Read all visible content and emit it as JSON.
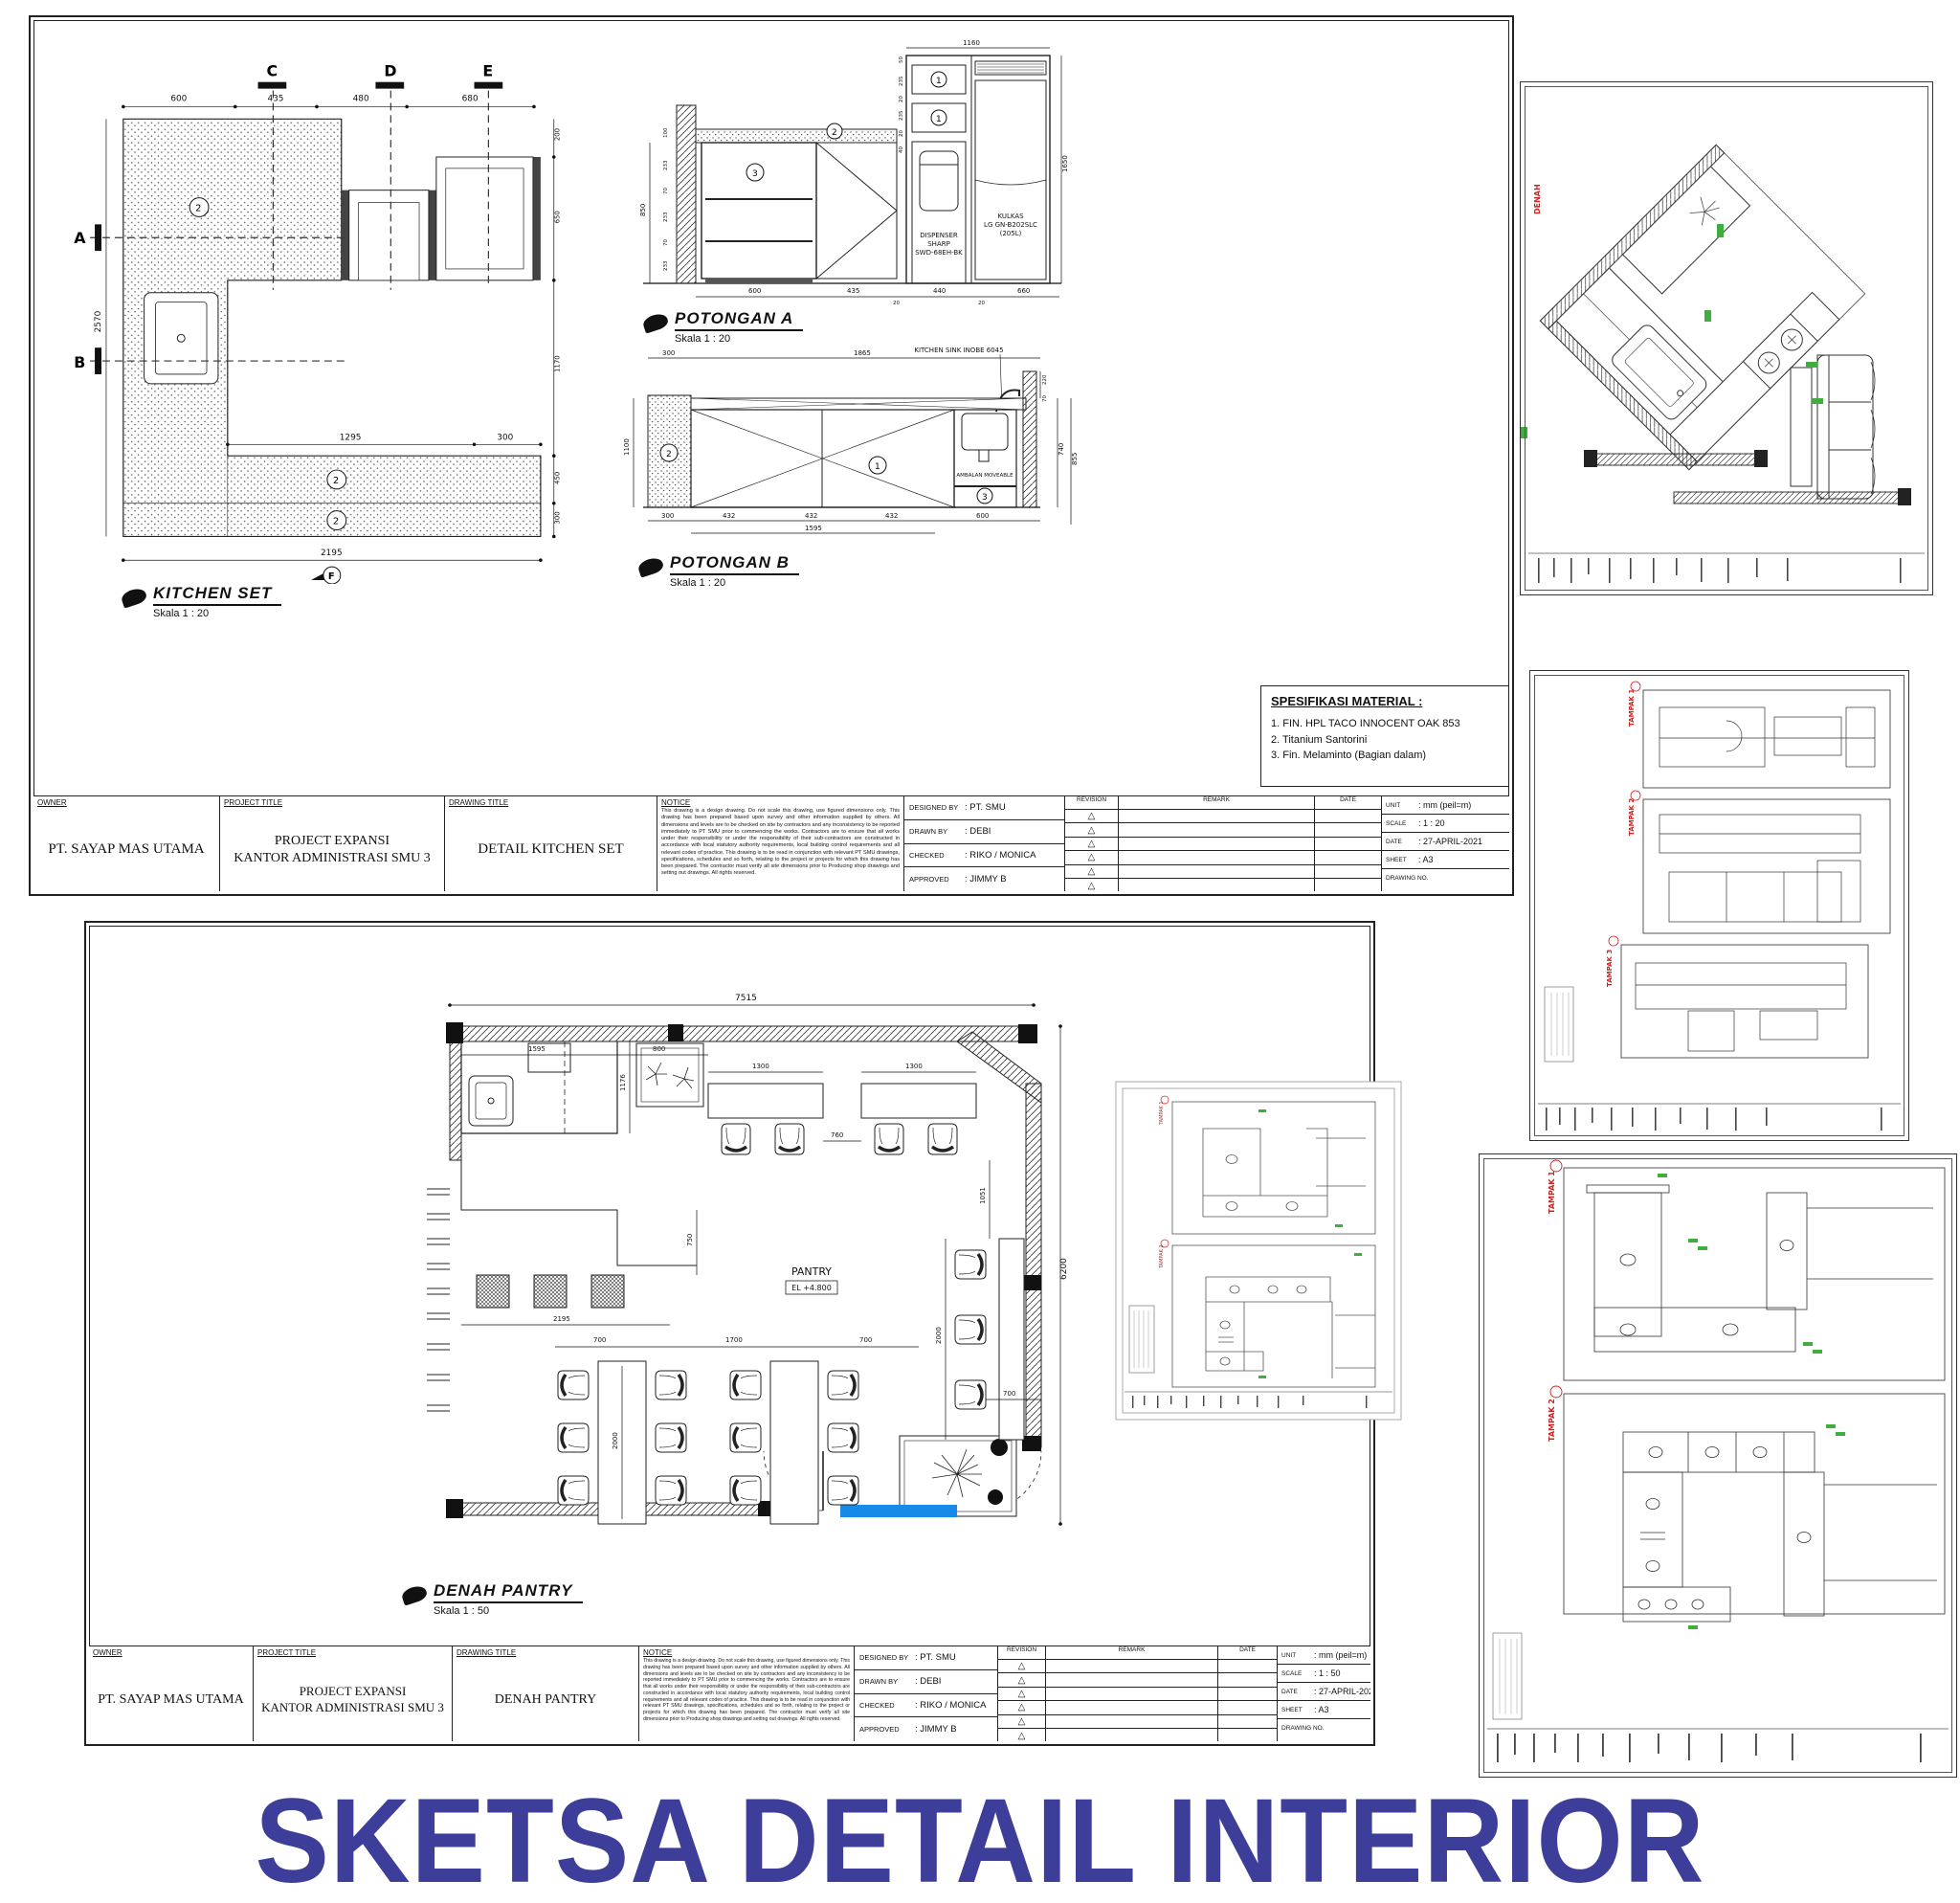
{
  "page": {
    "title": "SKETSA DETAIL INTERIOR"
  },
  "notice": "This drawing is a design drawing. Do not scale this drawing, use figured dimensions only. This drawing has been prepared based upon survey and other information supplied by others. All dimensions and levels are to be checked on site by contractors and any inconsistency to be reported immediately to PT SMU prior to commencing the works. Contractors are to ensure that all works under their responsibility or under the responsibility of their sub-contractors are constructed in accordance with local statutory authority requirements, local building control requirements and all relevant codes of practice. This drawing is to be read in conjunction with relevant PT SMU drawings, specifications, schedules and so forth, relating to the project or projects for which this drawing has been prepared. The contractor must verify all site dimensions prior to Producing shop drawings and setting out drawings. All rights reserved.",
  "tb_labels": {
    "owner": "OWNER",
    "project": "PROJECT TITLE",
    "drawing": "DRAWING TITLE",
    "notice": "NOTICE",
    "designed": "DESIGNED BY",
    "drawn": "DRAWN BY",
    "checked": "CHECKED",
    "approved": "APPROVED",
    "revision": "REVISION",
    "remark": "REMARK",
    "date": "DATE",
    "unit": "UNIT",
    "scale": "SCALE",
    "sheet": "SHEET",
    "drawing_no": "DRAWING NO.",
    "tri": "△"
  },
  "tb_common": {
    "owner": "PT. SAYAP MAS UTAMA",
    "project_line1": "PROJECT EXPANSI",
    "project_line2": "KANTOR ADMINISTRASI SMU 3",
    "designed": ": PT. SMU",
    "drawn": ": DEBI",
    "checked": ": RIKO / MONICA",
    "approved": ": JIMMY B",
    "unit": ": mm (peil=m)",
    "date": ": 27-APRIL-2021",
    "sheet": ": A3"
  },
  "sheet1": {
    "drawing_title": "DETAIL KITCHEN SET",
    "scale": ": 1 : 20",
    "kitchen": {
      "label": "KITCHEN SET",
      "scale": "Skala 1 : 20",
      "letters": {
        "a": "A",
        "b": "B",
        "c": "C",
        "d": "D",
        "e": "E",
        "f": "F"
      },
      "tag": "2",
      "dims": {
        "top": [
          "600",
          "435",
          "480",
          "680"
        ],
        "left": "2570",
        "right": [
          "200",
          "650",
          "1170",
          "450",
          "300"
        ],
        "inner": [
          "1295",
          "300"
        ],
        "bottom": "2195"
      }
    },
    "potA": {
      "label": "POTONGAN A",
      "scale": "Skala 1 : 20",
      "top": "1160",
      "right": "1650",
      "left_master": "850",
      "left_stack": [
        "100",
        "233",
        "70",
        "233",
        "70",
        "233"
      ],
      "unit_stack": [
        "50",
        "235",
        "20",
        "235",
        "20",
        "40"
      ],
      "bottom": [
        "600",
        "435",
        "20",
        "440",
        "20",
        "660"
      ],
      "dispenser": [
        "DISPENSER",
        "SHARP",
        "SWD-68EH-BK"
      ],
      "kulkas": [
        "KULKAS",
        "LG GN-B202SLC",
        "(205L)"
      ],
      "tags": {
        "t1": "1",
        "t2": "2",
        "t3": "3"
      }
    },
    "potB": {
      "label": "POTONGAN B",
      "scale": "Skala 1 : 20",
      "sink": "KITCHEN SINK INOBE 6045",
      "shelf": "AMBALAN MOVEABLE",
      "top": [
        "300",
        "1865"
      ],
      "right": [
        "220",
        "70",
        "740",
        "855"
      ],
      "left": "1100",
      "bottom": [
        "300",
        "432",
        "432",
        "432",
        "600"
      ],
      "bottom2": "1595",
      "tags": {
        "t1": "1",
        "t2": "2",
        "t3": "3"
      }
    },
    "spec": {
      "title": "SPESIFIKASI MATERIAL :",
      "items": [
        "1. FIN. HPL TACO INNOCENT OAK 853",
        "2. Titanium Santorini",
        "3. Fin. Melaminto (Bagian dalam)"
      ]
    }
  },
  "sheet2": {
    "drawing_title": "DENAH PANTRY",
    "scale": ": 1 : 50",
    "plan": {
      "label": "DENAH PANTRY",
      "scale": "Skala 1 : 50",
      "room": "PANTRY",
      "elev": "EL +4.800",
      "dims": {
        "top": "7515",
        "right": "6200",
        "r1": [
          "1595",
          "800"
        ],
        "tables_top": [
          "1300",
          "760",
          "1300"
        ],
        "v1": "1176",
        "v2": "750",
        "w": "2195",
        "row": [
          "700",
          "1700",
          "700"
        ],
        "t_len": "2000",
        "chairs_len": "2000",
        "c700": "700",
        "v3": "1051"
      }
    }
  },
  "insets": {
    "i1_label": "DENAH",
    "i2_labels": [
      "TAMPAK 1",
      "TAMPAK 2",
      "TAMPAK 3"
    ],
    "i3_labels": [
      "TAMPAK 1",
      "TAMPAK 2"
    ]
  }
}
